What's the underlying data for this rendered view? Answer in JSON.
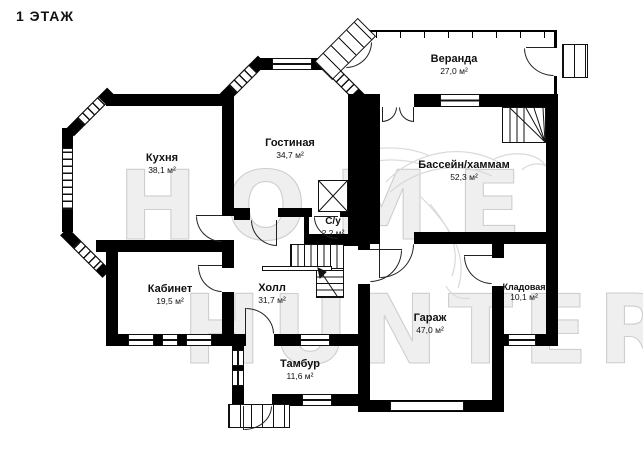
{
  "title": "1 ЭТАЖ",
  "watermark": {
    "line1": "HOME",
    "line2": "HUNTER"
  },
  "rooms": [
    {
      "id": "veranda",
      "name": "Веранда",
      "area": "27,0 м²"
    },
    {
      "id": "living",
      "name": "Гостиная",
      "area": "34,7 м²"
    },
    {
      "id": "kitchen",
      "name": "Кухня",
      "area": "38,1 м²"
    },
    {
      "id": "pool",
      "name": "Бассейн/хаммам",
      "area": "52,3 м²"
    },
    {
      "id": "wc",
      "name": "С/у",
      "area": "2,2 м²"
    },
    {
      "id": "office",
      "name": "Кабинет",
      "area": "19,5 м²"
    },
    {
      "id": "hall",
      "name": "Холл",
      "area": "31,7 м²"
    },
    {
      "id": "vestibule",
      "name": "Тамбур",
      "area": "11,6 м²"
    },
    {
      "id": "garage",
      "name": "Гараж",
      "area": "47,0 м²"
    },
    {
      "id": "storage",
      "name": "Кладовая",
      "area": "10,1 м²"
    }
  ],
  "colors": {
    "wall": "#000000",
    "text": "#111111",
    "watermark": "#cecece"
  }
}
